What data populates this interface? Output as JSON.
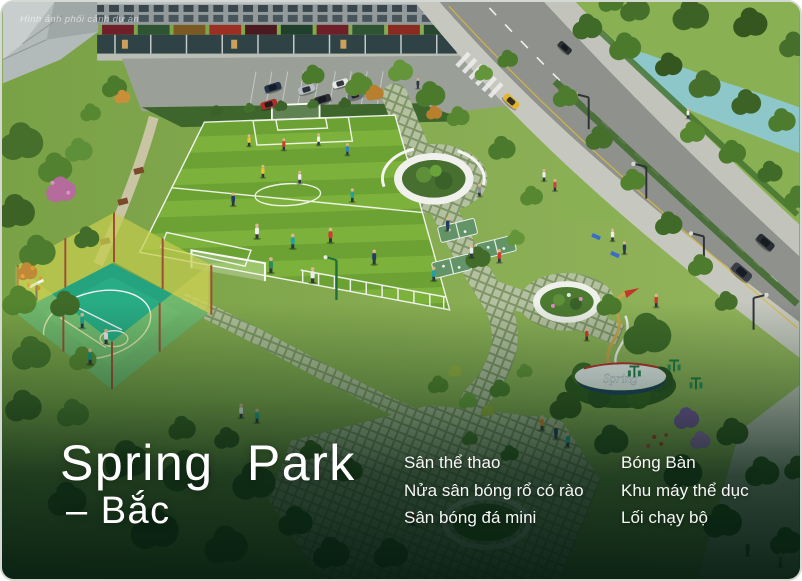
{
  "watermark": "Hình ảnh phối cảnh dự án",
  "title": {
    "line1": "Spring Park",
    "line2": "– Bắc"
  },
  "amenities": {
    "col1": [
      "Sân thể thao",
      "Nửa sân bóng rổ có rào",
      "Sân bóng đá mini"
    ],
    "col2": [
      "Bóng Bàn",
      "Khu máy thể dục",
      "Lối chạy bộ"
    ]
  },
  "spring_sign_label": "Spring",
  "colors": {
    "text": "#ffffff",
    "overlay_green": "#06261a",
    "field_green_light": "#7cb23b",
    "field_green_dark": "#6ca134",
    "court_teal": "#25a37e",
    "fence_yellow": "#c4cc4e",
    "road_gray": "#8f918c",
    "river_teal": "#8ec7c9",
    "sign_navy": "#1d3f66",
    "sign_red": "#b8322a"
  }
}
